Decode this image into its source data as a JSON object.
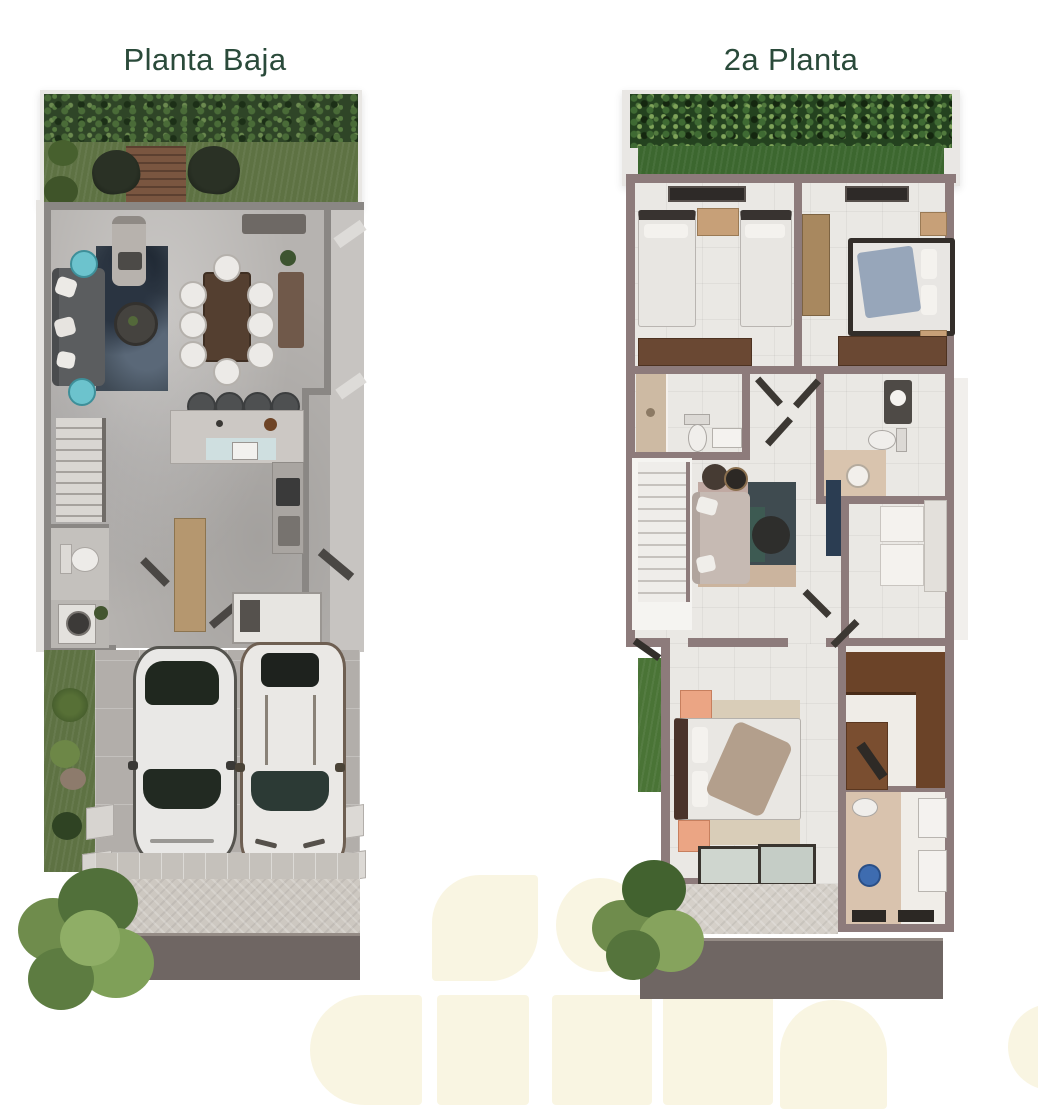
{
  "document": {
    "kind": "real-estate floor plan sheet",
    "background_color": "#ffffff",
    "watermark_color": "#f9f5e2",
    "title_color": "#2a4a3a"
  },
  "plans": [
    {
      "title": "Planta Baja",
      "features": [
        "back-garden",
        "hedge",
        "wood-deck",
        "hanging-chairs",
        "living-room-sofa",
        "teal-side-tables",
        "round-coffee-table",
        "dining-table-eight-chairs",
        "kitchen-island-four-stools",
        "l-shaped-counter",
        "staircase",
        "half-bathroom",
        "laundry",
        "storage-box",
        "entry-console",
        "side-garden",
        "two-car-driveway",
        "sedan-car",
        "suv-car",
        "sidewalk",
        "street",
        "tree"
      ]
    },
    {
      "title": "2a Planta",
      "features": [
        "roof-garden-hedge",
        "twin-bedroom",
        "secondary-bedroom",
        "wardrobe-closets",
        "bathroom-left",
        "bathroom-right",
        "hallway-doors",
        "staircase",
        "family-room-sofa",
        "area-rug",
        "nesting-tables",
        "tv-console",
        "study-desks",
        "master-bedroom",
        "peach-benches",
        "walk-in-closet",
        "master-bathroom",
        "double-vanity",
        "balcony",
        "street",
        "tree"
      ]
    }
  ],
  "palette": {
    "wall_ground_floor": "#8a8784",
    "wall_second_floor": "#8d7b7b",
    "grass_left": "#5e7243",
    "grass_right": "#3c672f",
    "hedge_left": "#2f4527",
    "hedge_right": "#24421f",
    "concrete_floor": "#b6b3b0",
    "tile_floor": "#eae8e4",
    "road": "#6f6663",
    "deck_wood": "#6e4c38",
    "closet_wood": "#6b4833",
    "accent_teal": "#6cc3cd",
    "accent_peach": "#eba584",
    "accent_blue": "#3e6cb0",
    "rug_navy": "#3f4a55",
    "bedding_blue": "#97a6ba"
  }
}
